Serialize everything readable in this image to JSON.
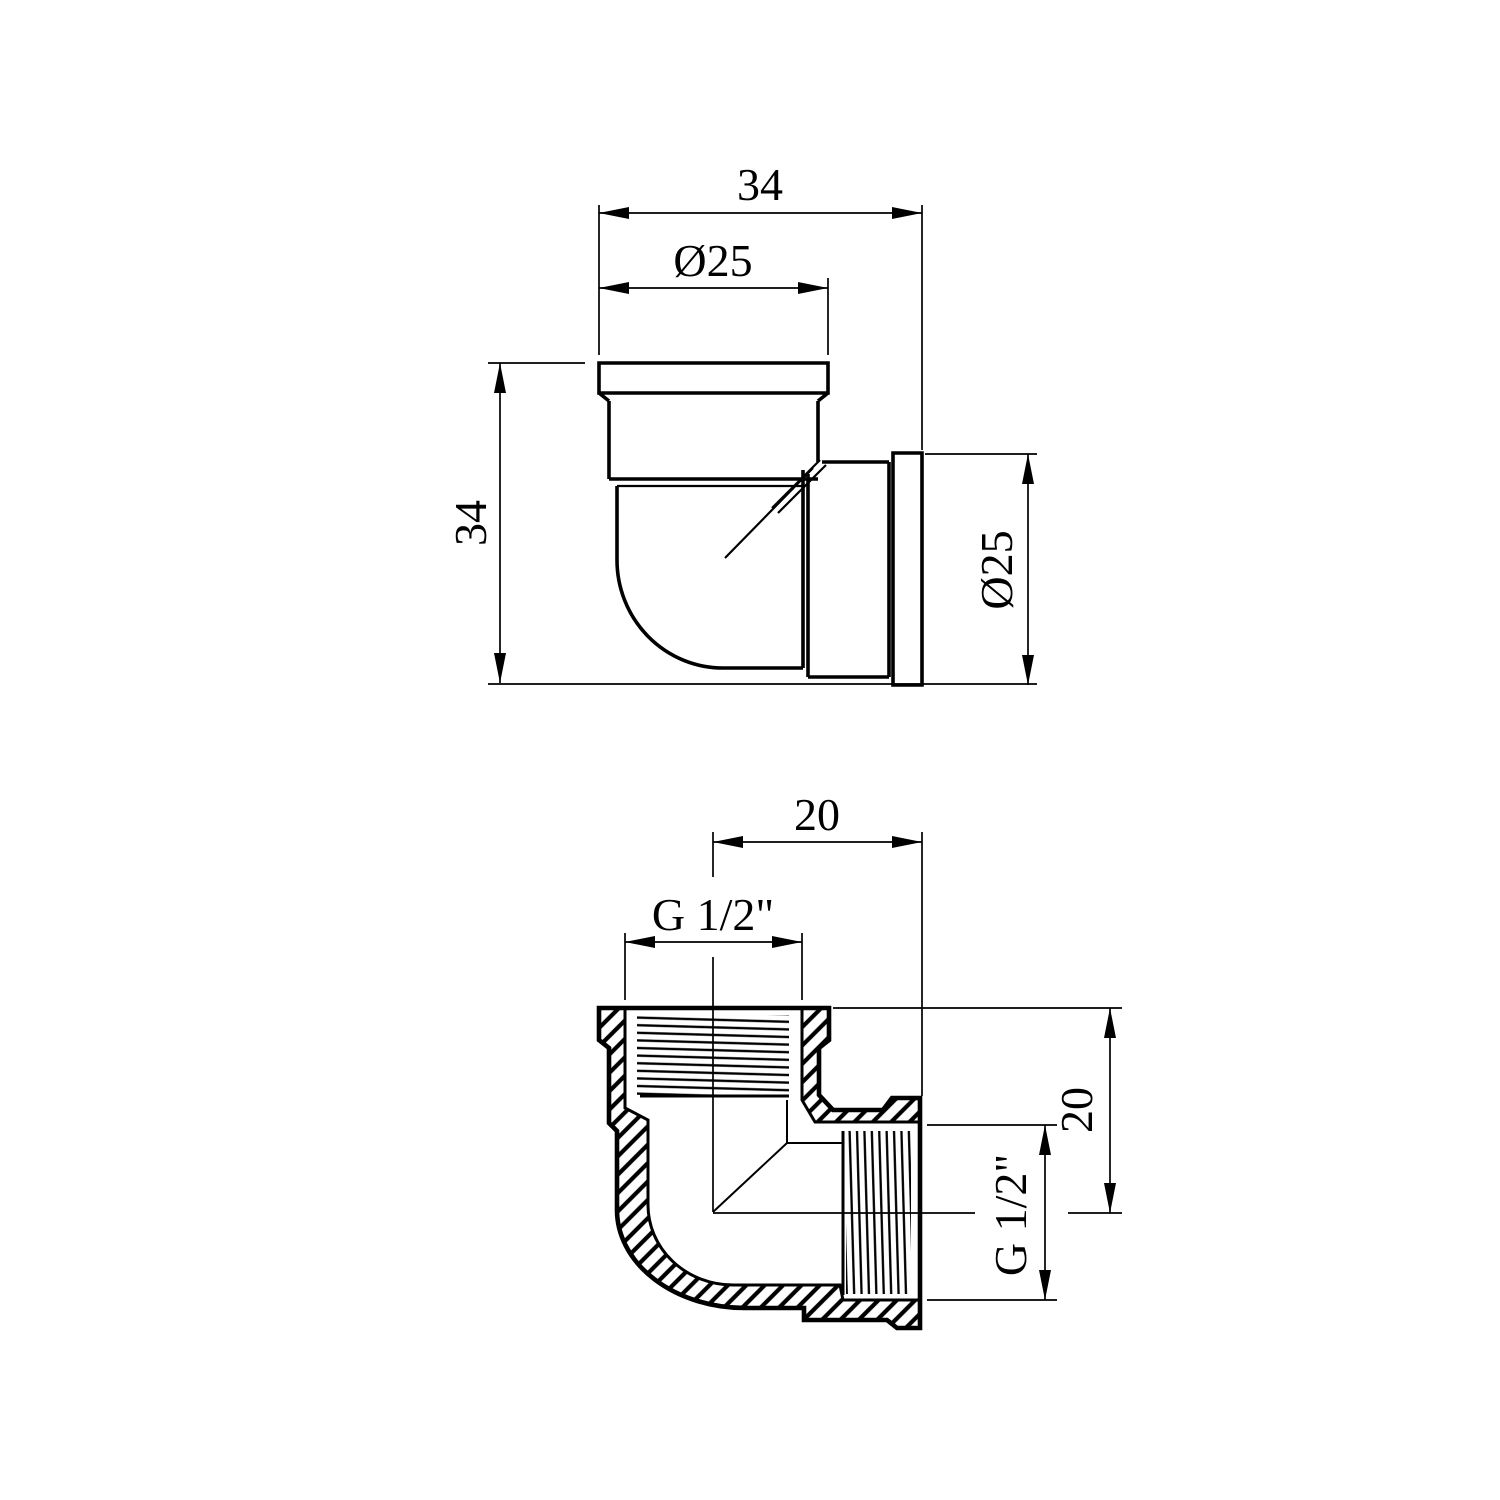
{
  "page": {
    "background": "#ffffff",
    "line_color": "#000000",
    "text_color": "#000000",
    "content": "technical drawing of 90-degree female threaded pipe elbow, two views with dimensions"
  },
  "front_view": {
    "name": "elbow external view",
    "dims": {
      "overall_width": "34",
      "top_port_diameter": "Ø25",
      "overall_height": "34",
      "side_port_diameter": "Ø25"
    }
  },
  "section_view": {
    "name": "elbow cross-section view",
    "dims": {
      "center_to_top_face": "20",
      "top_thread_size": "G 1/2\"",
      "center_to_side_face": "20",
      "side_thread_size": "G 1/2\""
    }
  }
}
